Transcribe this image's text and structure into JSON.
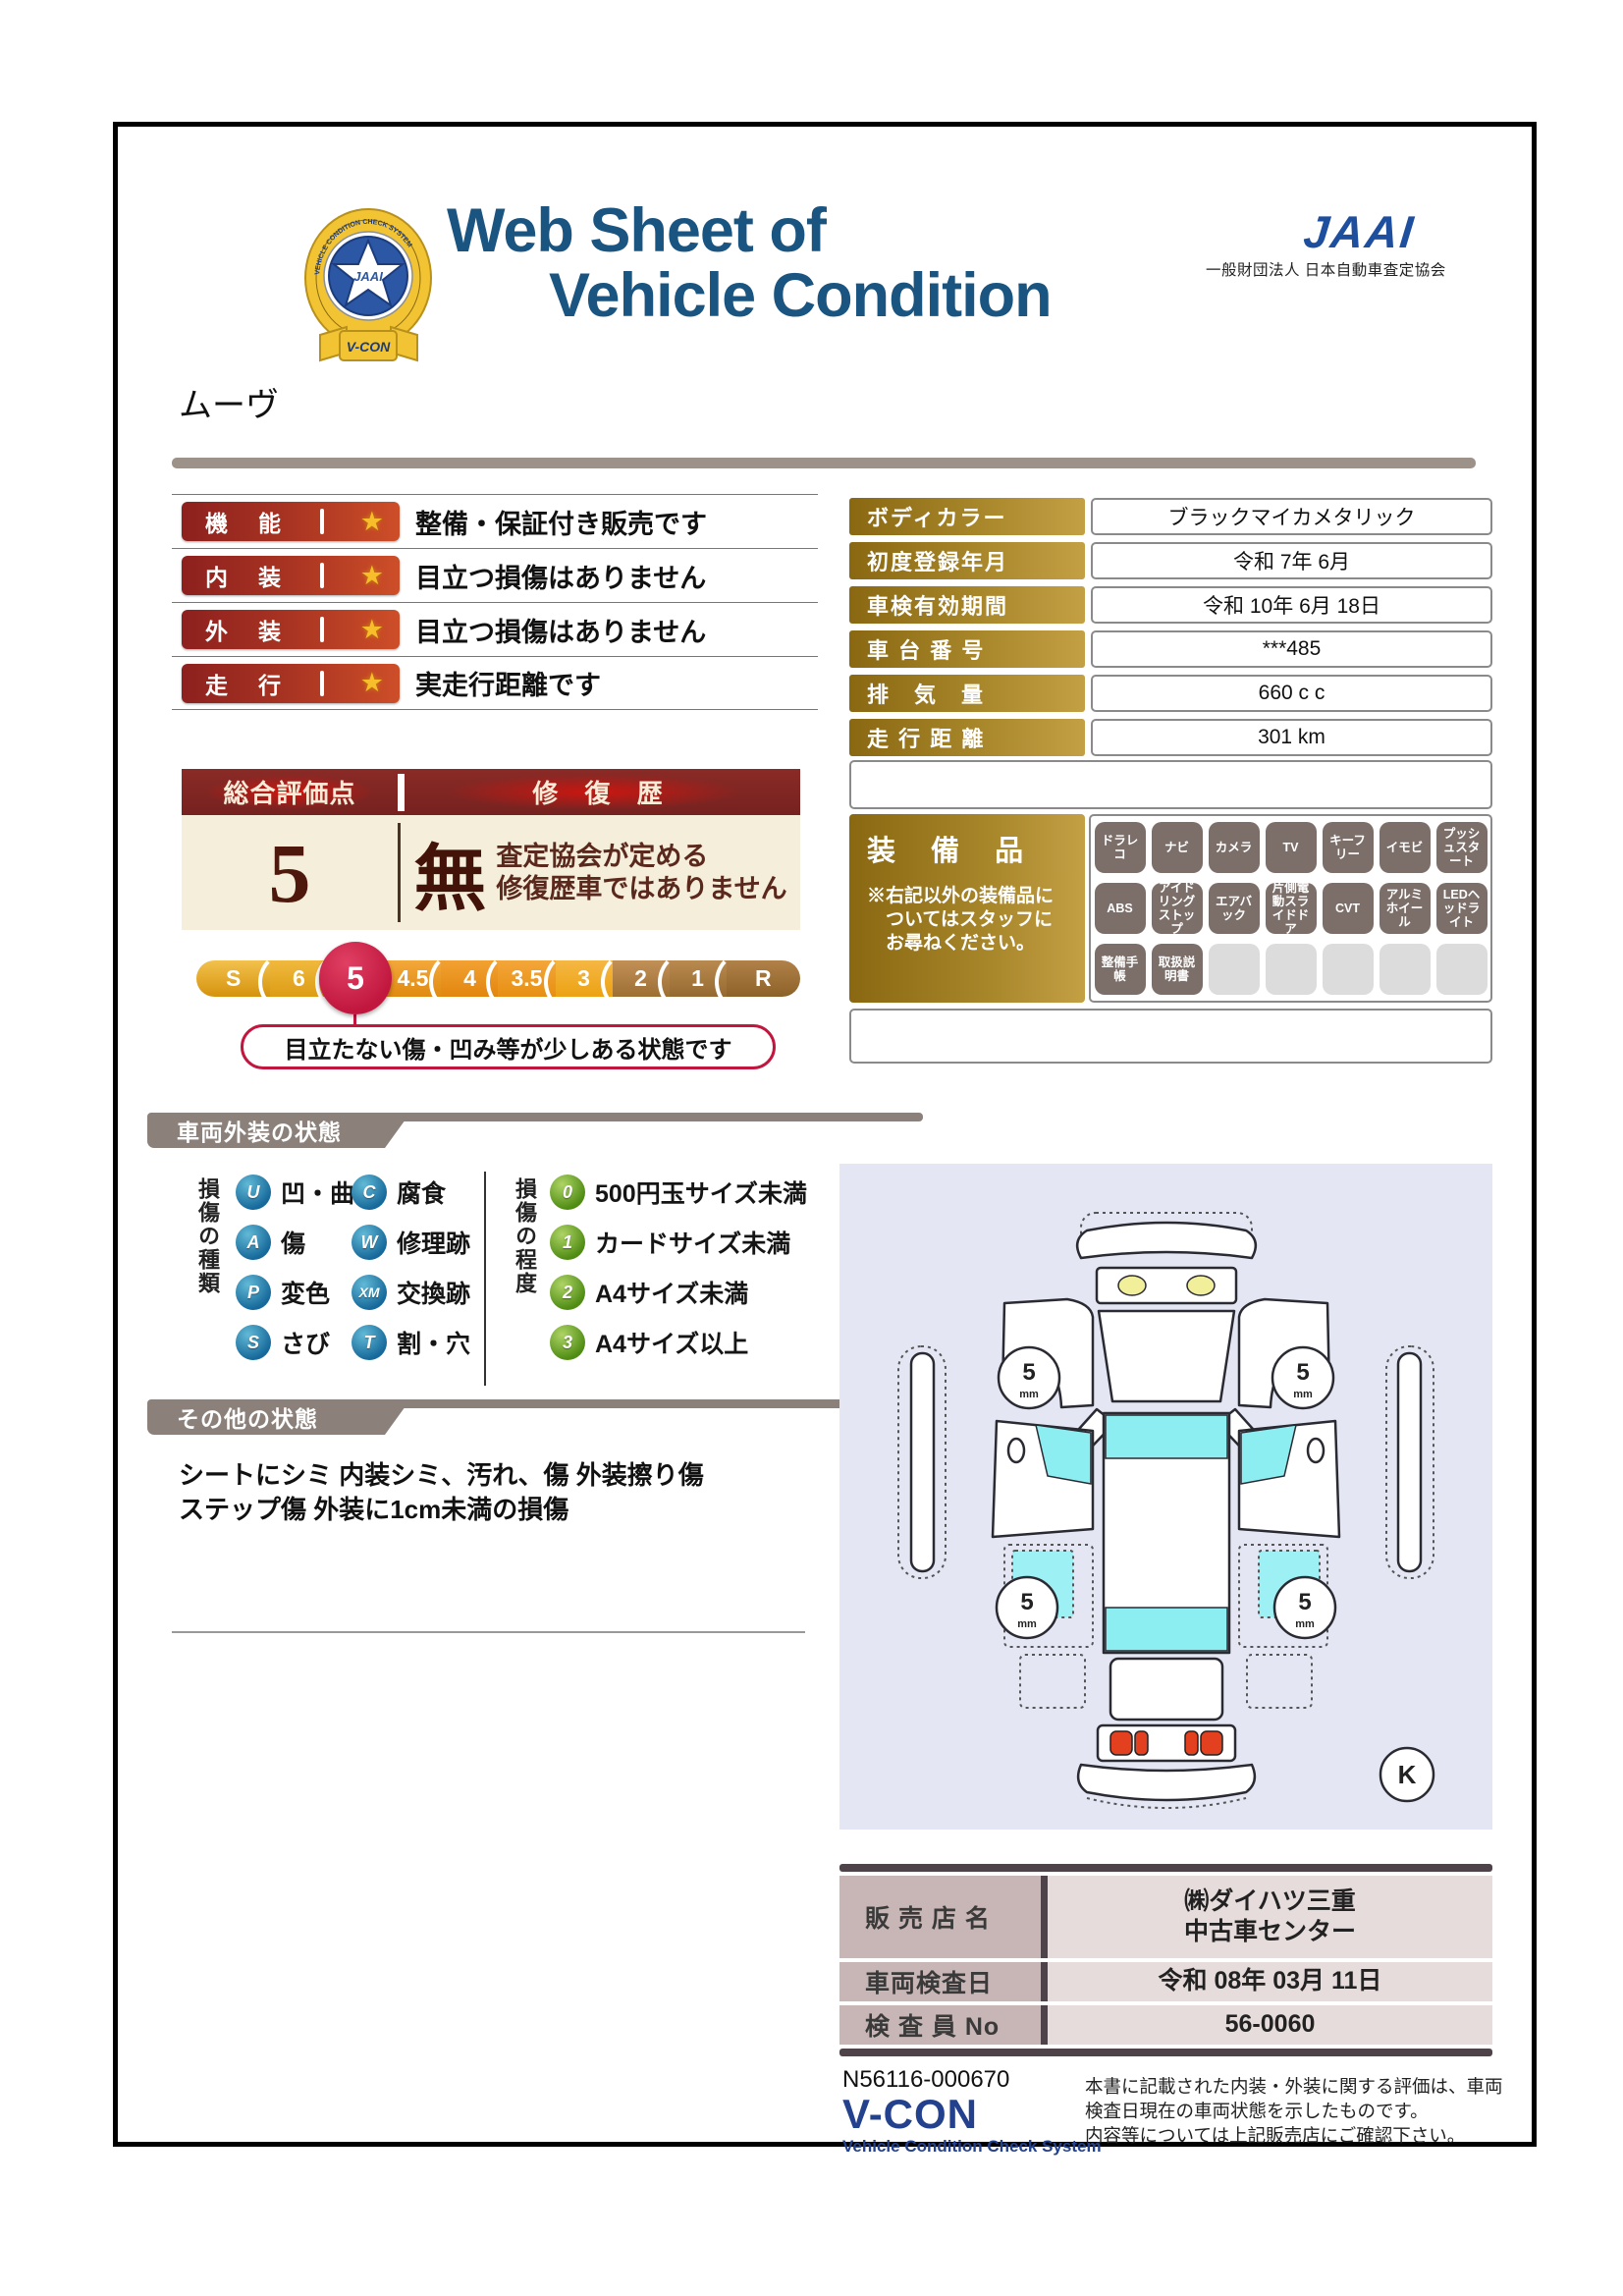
{
  "header": {
    "title_line1": "Web Sheet of",
    "title_line2": "Vehicle Condition",
    "jaai_logo": "JAAI",
    "jaai_subtext": "一般財団法人 日本自動車査定協会",
    "emblem": {
      "jaai": "JAAI",
      "ring_text": "VEHICLE CONDITION CHECK SYSTEM",
      "ribbon": "V-CON"
    }
  },
  "vehicle_name": "ムーヴ",
  "ratings": [
    {
      "label": "機　能",
      "desc": "整備・保証付き販売です"
    },
    {
      "label": "内　装",
      "desc": "目立つ損傷はありません"
    },
    {
      "label": "外　装",
      "desc": "目立つ損傷はありません"
    },
    {
      "label": "走　行",
      "desc": "実走行距離です"
    }
  ],
  "info_table": {
    "rows": [
      {
        "label": "ボディカラー",
        "value": "ブラックマイカメタリック"
      },
      {
        "label": "初度登録年月",
        "value": "令和 7年 6月"
      },
      {
        "label": "車検有効期間",
        "value": "令和 10年 6月 18日"
      },
      {
        "label": "車 台 番 号",
        "value": "***485"
      },
      {
        "label": "排　気　量",
        "value": "660 c c"
      },
      {
        "label": "走 行 距 離",
        "value": "301 km"
      }
    ]
  },
  "overall": {
    "header_left": "総合評価点",
    "header_right": "修 復 歴",
    "score": "5",
    "repair": "無",
    "repair_desc_line1": "査定協会が定める",
    "repair_desc_line2": "修復歴車ではありません",
    "scale": [
      "S",
      "6",
      "5",
      "4.5",
      "4",
      "3.5",
      "3",
      "2",
      "1",
      "R"
    ],
    "selected": "5",
    "callout": "目立たない傷・凹み等が少しある状態です"
  },
  "equipment": {
    "title": "装 備 品",
    "note_line1": "※右記以外の装備品に",
    "note_line2": "ついてはスタッフに",
    "note_line3": "お尋ねください。",
    "badges": [
      "ドラレコ",
      "ナビ",
      "カメラ",
      "TV",
      "キーフリー",
      "イモビ",
      "プッシュスタート",
      "ABS",
      "アイドリングストップ",
      "エアバック",
      "片側電動スライドドア",
      "CVT",
      "アルミホイール",
      "LEDヘッドライト",
      "整備手帳",
      "取扱説明書"
    ]
  },
  "exterior_legend": {
    "title": "車両外装の状態",
    "type_label": "損傷の種類",
    "types": [
      {
        "code": "U",
        "label": "凹・曲"
      },
      {
        "code": "C",
        "label": "腐食"
      },
      {
        "code": "A",
        "label": "傷"
      },
      {
        "code": "W",
        "label": "修理跡"
      },
      {
        "code": "P",
        "label": "変色"
      },
      {
        "code": "XM",
        "label": "交換跡"
      },
      {
        "code": "S",
        "label": "さび"
      },
      {
        "code": "T",
        "label": "割・穴"
      }
    ],
    "degree_label": "損傷の程度",
    "degrees": [
      {
        "code": "0",
        "label": "500円玉サイズ未満"
      },
      {
        "code": "1",
        "label": "カードサイズ未満"
      },
      {
        "code": "2",
        "label": "A4サイズ未満"
      },
      {
        "code": "3",
        "label": "A4サイズ以上"
      }
    ]
  },
  "other_condition": {
    "title": "その他の状態",
    "line1": "シートにシミ 内装シミ、汚れ、傷 外装擦り傷",
    "line2": "ステップ傷 外装に1cm未満の損傷"
  },
  "diagram": {
    "tire_value": "5",
    "tire_unit": "mm",
    "corner_mark": "K"
  },
  "dealer": {
    "rows": [
      {
        "label": "販 売 店 名",
        "value_line1": "㈱ダイハツ三重",
        "value_line2": "中古車センター"
      },
      {
        "label": "車両検査日",
        "value": "令和 08年 03月 11日"
      },
      {
        "label": "検 査 員 No",
        "value": "56-0060"
      }
    ]
  },
  "footer": {
    "doc_number": "N56116-000670",
    "brand": "V-CON",
    "brand_sub": "Vehicle Condition Check System",
    "disclaimer_line1": "本書に記載された内装・外装に関する評価は、車両",
    "disclaimer_line2": "検査日現在の車両状態を示したものです。",
    "disclaimer_line3": "内容等については上記販売店にご確認下さい。"
  },
  "colors": {
    "title_navy": "#1a5480",
    "jaai_blue": "#1e4f9f",
    "rating_red": "#a93422",
    "gold": "#a8862a",
    "maroon": "#7a2a26",
    "cream": "#f4eedb",
    "crimson": "#c1173f",
    "section_gray": "#8c817a",
    "diagram_bg": "#e4e7f3",
    "window_cyan": "#8deef1"
  }
}
